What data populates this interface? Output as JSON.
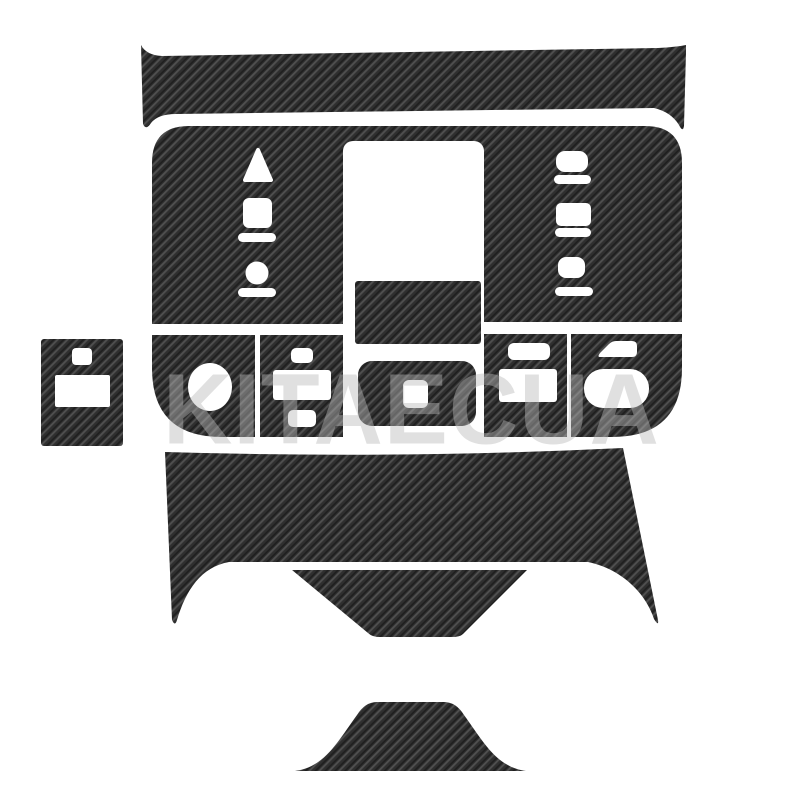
{
  "product_image": {
    "description": "Carbon fiber interior trim decal sticker kit for car center console, pieces laid out on white background",
    "background_color": "#ffffff"
  },
  "watermark": {
    "text": "KITAECUA"
  },
  "palette": {
    "carbon_base": "#2f2f2f",
    "carbon_highlight": "#505050",
    "carbon_shadow": "#1e1e1e",
    "cutout_color": "#ffffff",
    "watermark_color": "rgba(187,187,187,0.45)"
  },
  "pieces": [
    {
      "name": "top-trim-strip",
      "role": "upper dashboard trim bar with pointed ends"
    },
    {
      "name": "main-console-plate",
      "role": "central console surround plate"
    },
    {
      "name": "gear-selector-panel",
      "role": "left panel with triangle, square, bars, circle cutouts"
    },
    {
      "name": "right-switch-panel",
      "role": "right panel with three button-group cutouts"
    },
    {
      "name": "center-display-rect",
      "role": "small rectangular screen trim"
    },
    {
      "name": "center-button-bezel",
      "role": "rounded bezel with single button hole"
    },
    {
      "name": "round-knob-panel",
      "role": "button row panel with oval knob hole"
    },
    {
      "name": "plus-button-panel",
      "role": "button row panel with three rectangular holes"
    },
    {
      "name": "right-button-panel",
      "role": "button row panel with two rectangular holes"
    },
    {
      "name": "corner-button-panel",
      "role": "button row panel with wedge and pill holes"
    },
    {
      "name": "side-accessory-panel",
      "role": "small separate square panel with two holes"
    },
    {
      "name": "lower-console-panel",
      "role": "lower console piece with two legs and slit"
    },
    {
      "name": "center-tongue-piece",
      "role": "inverted trapezoid tongue piece"
    },
    {
      "name": "bottom-hill-piece",
      "role": "small hill-shaped trim piece"
    }
  ]
}
